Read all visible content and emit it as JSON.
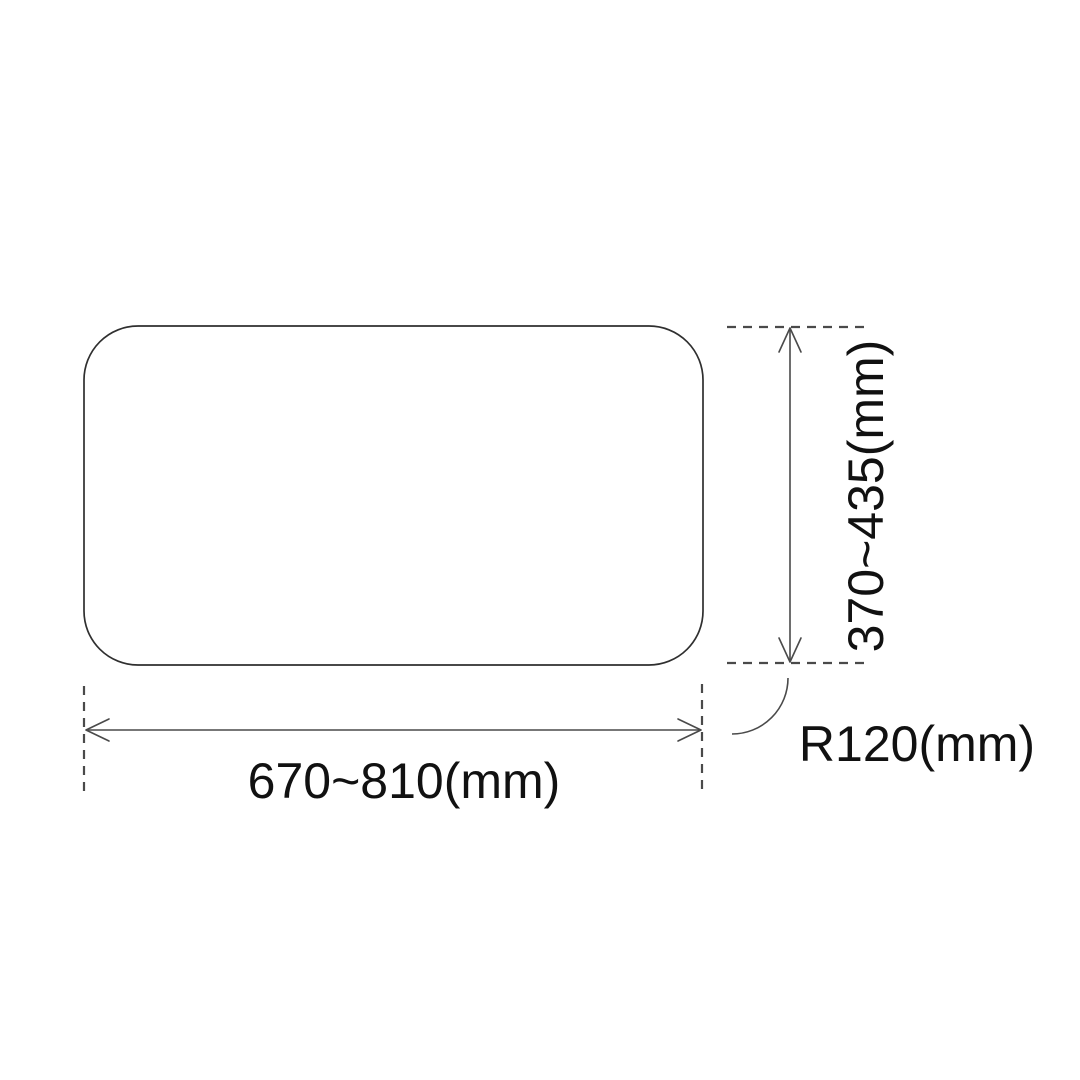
{
  "labels": {
    "width": "670~810(mm)",
    "height": "370~435(mm)",
    "radius": "R120(mm)"
  },
  "colors": {
    "background": "#ffffff",
    "outline": "#2f2f2f",
    "dimension_line": "#4a4a4a",
    "dashed_line": "#4a4a4a",
    "text": "#111111"
  }
}
